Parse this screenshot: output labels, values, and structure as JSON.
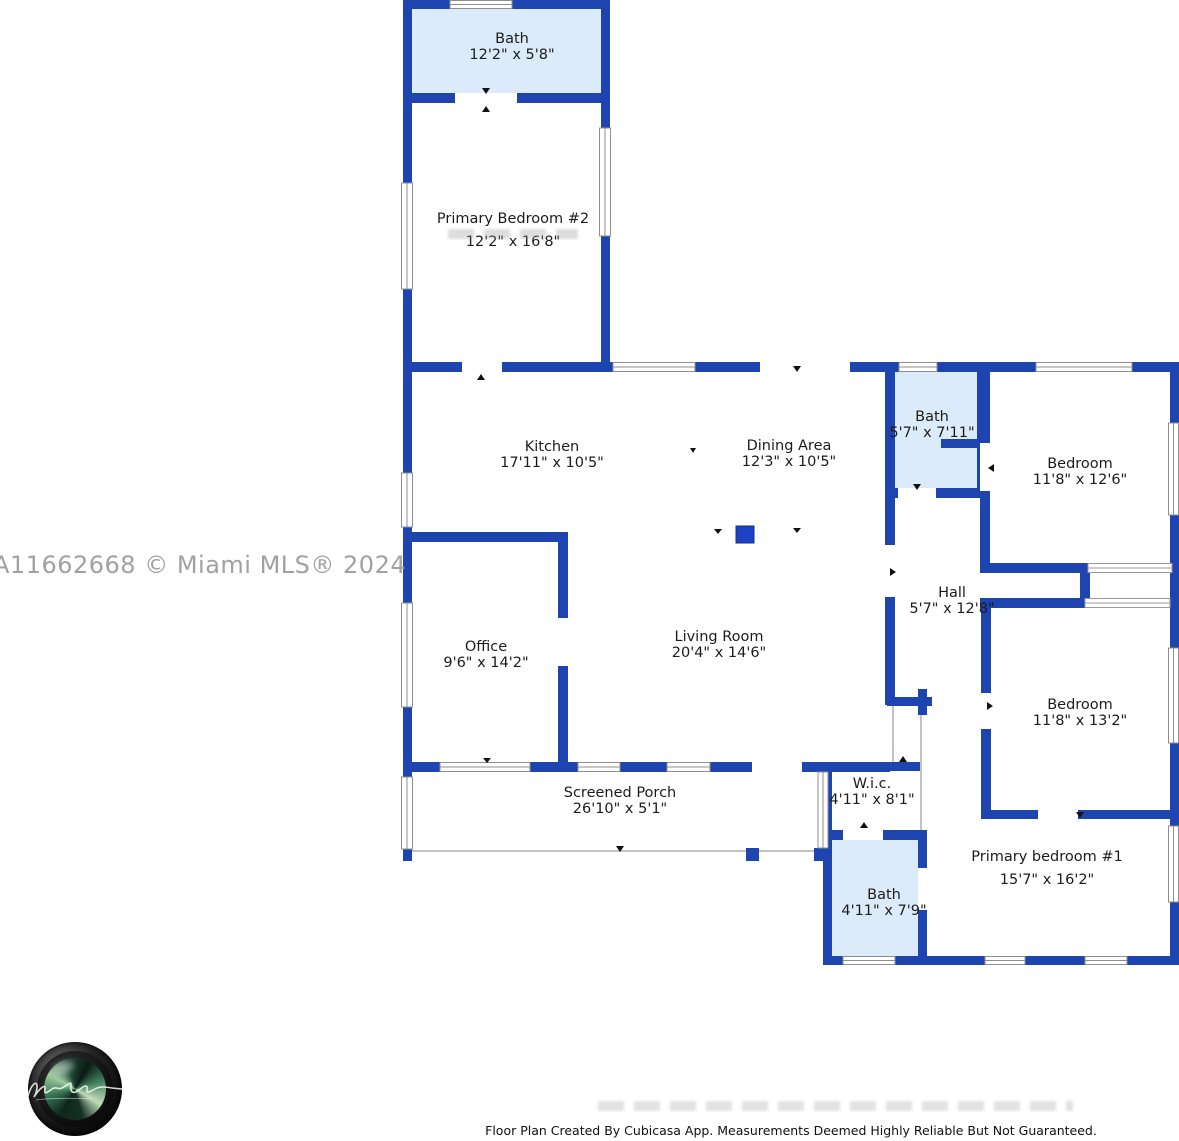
{
  "watermark": "A11662668 © Miami MLS® 2024",
  "disclaimer": "Floor Plan Created By Cubicasa App. Measurements Deemed Highly Reliable But Not Guaranteed.",
  "colors": {
    "wall": "#1e44b0",
    "column": "#1d43c4",
    "bath_fill": "#dcebf9",
    "window_frame": "#8f8f8f",
    "label_text": "#1c1c1c",
    "watermark_gray": "#a1a1a1"
  },
  "rooms": [
    {
      "id": "bath-top",
      "name": "Bath",
      "dims": "12'2\" x 5'8\""
    },
    {
      "id": "primary-bedroom-2",
      "name": "Primary Bedroom #2",
      "dims": "12'2\" x 16'8\""
    },
    {
      "id": "kitchen",
      "name": "Kitchen",
      "dims": "17'11\" x 10'5\""
    },
    {
      "id": "dining-area",
      "name": "Dining Area",
      "dims": "12'3\" x 10'5\""
    },
    {
      "id": "bath-middle",
      "name": "Bath",
      "dims": "5'7\" x 7'11\""
    },
    {
      "id": "bedroom-upper-right",
      "name": "Bedroom",
      "dims": "11'8\" x 12'6\""
    },
    {
      "id": "office",
      "name": "Office",
      "dims": "9'6\" x 14'2\""
    },
    {
      "id": "living-room",
      "name": "Living Room",
      "dims": "20'4\" x 14'6\""
    },
    {
      "id": "hall",
      "name": "Hall",
      "dims": "5'7\" x 12'8\""
    },
    {
      "id": "bedroom-lower-right",
      "name": "Bedroom",
      "dims": "11'8\" x 13'2\""
    },
    {
      "id": "screened-porch",
      "name": "Screened Porch",
      "dims": "26'10\" x 5'1\""
    },
    {
      "id": "wic",
      "name": "W.i.c.",
      "dims": "4'11\" x 8'1\""
    },
    {
      "id": "bath-bottom",
      "name": "Bath",
      "dims": "4'11\" x 7'9\""
    },
    {
      "id": "primary-bedroom-1",
      "name": "Primary bedroom #1",
      "dims": "15'7\" x 16'2\""
    }
  ],
  "logo": {
    "label": "photographer camera lens logo with script signature"
  }
}
